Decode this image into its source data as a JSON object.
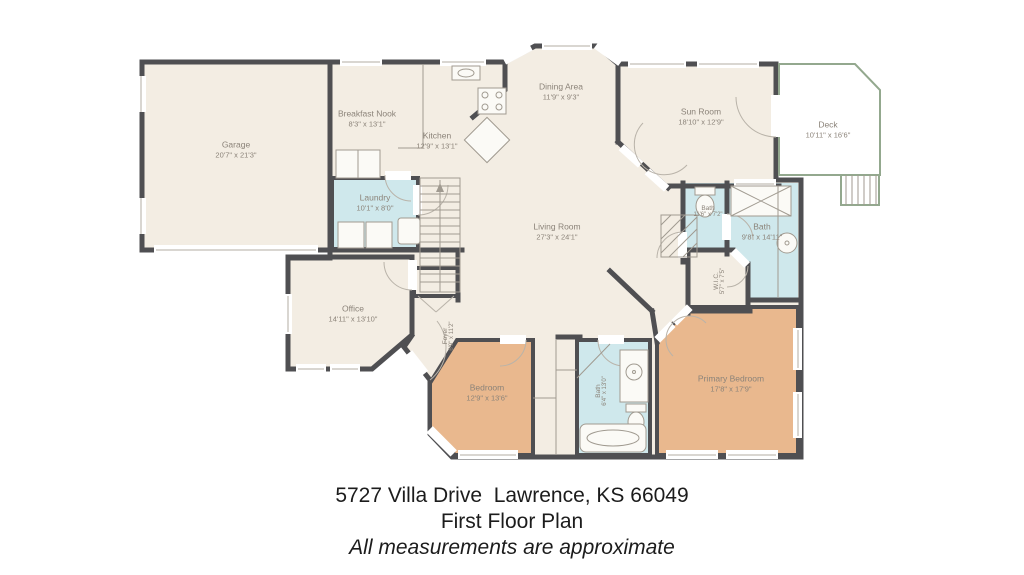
{
  "caption": {
    "address": "5727 Villa Drive  Lawrence, KS 66049",
    "plan_name": "First Floor Plan",
    "note": "All measurements are approximate"
  },
  "rooms": {
    "garage": {
      "name": "Garage",
      "dims": "20'7\" x 21'3\""
    },
    "breakfast_nook": {
      "name": "Breakfast Nook",
      "dims": "8'3\" x 13'1\""
    },
    "kitchen": {
      "name": "Kitchen",
      "dims": "12'9\" x 13'1\""
    },
    "dining_area": {
      "name": "Dining Area",
      "dims": "11'9\" x 9'3\""
    },
    "sun_room": {
      "name": "Sun Room",
      "dims": "18'10\" x 12'9\""
    },
    "deck": {
      "name": "Deck",
      "dims": "10'11\" x 16'6\""
    },
    "laundry": {
      "name": "Laundry",
      "dims": "10'1\" x 8'0\""
    },
    "living_room": {
      "name": "Living Room",
      "dims": "27'3\" x 24'1\""
    },
    "bath_hall": {
      "name": "Bath",
      "dims": "11'6\" x 7'2\""
    },
    "bath_main": {
      "name": "Bath",
      "dims": "9'8\" x 14'11\""
    },
    "wic": {
      "name": "W.I.C.",
      "dims": "5'7\" x 7'5\""
    },
    "office": {
      "name": "Office",
      "dims": "14'11\" x 13'10\""
    },
    "foyer": {
      "name": "Foyer",
      "dims": "6'9\" x 11'2\""
    },
    "bedroom": {
      "name": "Bedroom",
      "dims": "12'9\" x 13'6\""
    },
    "bath_shared": {
      "name": "Bath",
      "dims": "6'4\" x 13'0\""
    },
    "primary_bedroom": {
      "name": "Primary Bedroom",
      "dims": "17'8\" x 17'9\""
    }
  },
  "colors": {
    "background": "#ffffff",
    "wall": "#4f4f52",
    "floor": "#f3ede3",
    "water_rooms": "#cfe8ec",
    "bedrooms": "#e9b88e",
    "deck": "#bccfb5",
    "label_text": "#8b8379",
    "caption_text": "#1c1c1c"
  }
}
